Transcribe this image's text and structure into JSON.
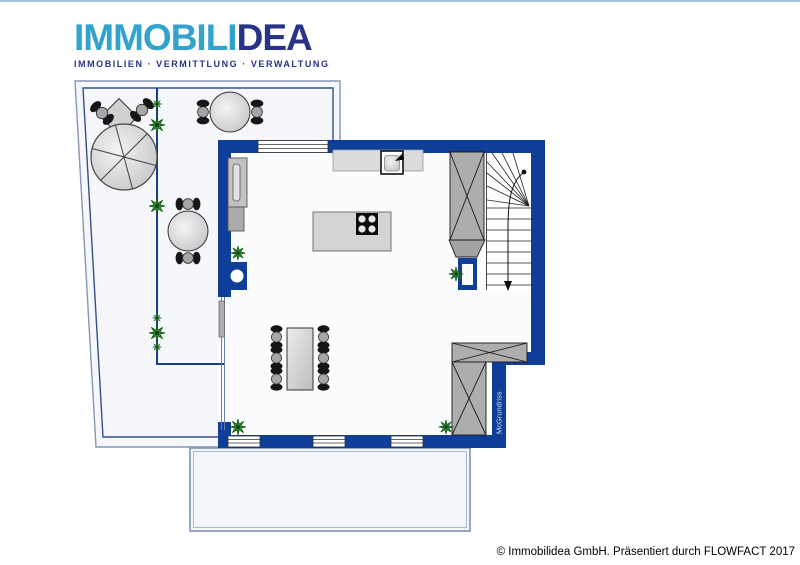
{
  "header": {
    "brand_primary": "IMMOBILI",
    "brand_secondary": "DEA",
    "tagline": "IMMOBILIEN · VERMITTLUNG · VERWALTUNG"
  },
  "floor_plan": {
    "watermark": "McGrundriss",
    "elements": {
      "terrace": [
        "parasol",
        "garden-chairs",
        "round-table-with-2-chairs",
        "round-table-with-2-chairs",
        "hedge-with-plants"
      ],
      "living_kitchen": [
        "kitchen-counter-with-sink",
        "kitchen-island-with-cooktop",
        "tall-cabinet",
        "dining-table-with-6-chairs",
        "potted-plants",
        "glass-front"
      ],
      "stair_area": [
        "winder-staircase-down",
        "wardrobe",
        "door-opening"
      ],
      "bottom_right": [
        "l-shaped-wardrobe"
      ],
      "balcony": "open-balcony"
    }
  },
  "footer": {
    "copyright": "© Immobilidea GmbH. Präsentiert durch FLOWFACT 2017"
  },
  "colors": {
    "wall": "#0e3e97",
    "outline": "#33508f",
    "brand_primary": "#31a3cc",
    "brand_secondary": "#283287",
    "plan_background": "#f5f7fb",
    "plant": "#2e9430",
    "top_border": "#a3c4e2"
  }
}
